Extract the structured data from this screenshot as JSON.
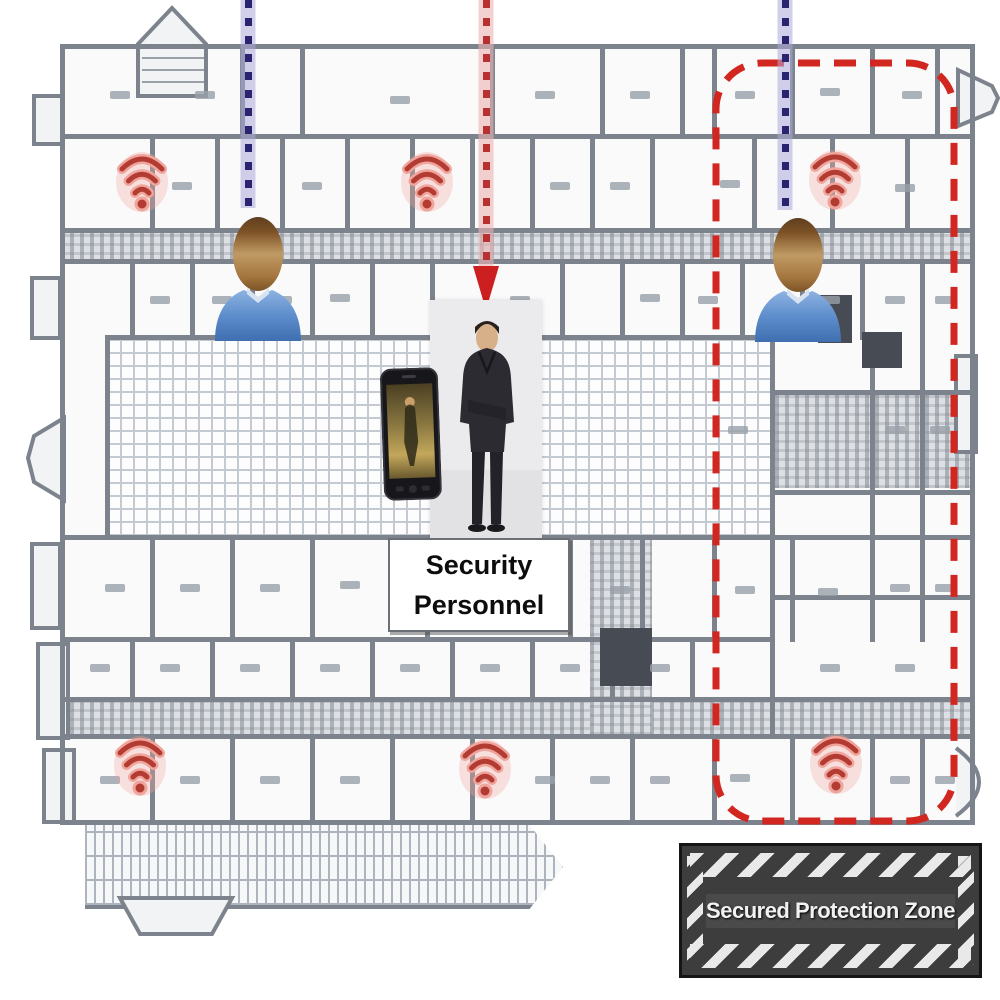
{
  "scene": {
    "description": "Building floor plan with security monitoring overlay",
    "background": "#ffffff"
  },
  "floor_plan": {
    "wall_color": "#7d838c",
    "hatch_color": "#c4cad2",
    "corridor_color": "#dcdfe3"
  },
  "secured_zone": {
    "x": 716,
    "y": 63,
    "w": 238,
    "h": 758,
    "corner_radius": 46,
    "color": "#d22720",
    "dash_pattern": "22 14",
    "stroke_width": 7
  },
  "sign": {
    "text": "Secured Protection Zone",
    "x": 679,
    "y": 843,
    "w": 303,
    "h": 135,
    "bg": "#3d3d3d",
    "stripe_color": "#e9e9e9",
    "border": "#151515",
    "text_color": "#f1f1f1"
  },
  "guard_label": {
    "line1": "Security",
    "line2": "Personnel",
    "x": 388,
    "y": 538,
    "w": 178,
    "h": 90,
    "bg": "#ffffff",
    "text_color": "#0d0d0d"
  },
  "tracking_lines": [
    {
      "id": "tracking-line-left",
      "x": 248,
      "y_start": 0,
      "y_end": 208,
      "dot_color": "#2a2370",
      "halo_color": "rgba(173,168,216,0.55)"
    },
    {
      "id": "tracking-line-right",
      "x": 785,
      "y_start": 0,
      "y_end": 210,
      "dot_color": "#2a2370",
      "halo_color": "rgba(173,168,216,0.55)"
    }
  ],
  "alert_arrow": {
    "x": 486,
    "y_start": 0,
    "shaft_end": 266,
    "tip_y": 310,
    "dot_color": "#b83030",
    "halo_color": "rgba(235,178,178,0.6)",
    "head_color": "#cc1f1f"
  },
  "wifi_access_points": [
    {
      "x": 142,
      "y": 183
    },
    {
      "x": 427,
      "y": 183
    },
    {
      "x": 835,
      "y": 181
    },
    {
      "x": 140,
      "y": 767
    },
    {
      "x": 485,
      "y": 770
    },
    {
      "x": 836,
      "y": 765
    }
  ],
  "wifi_style": {
    "arc_color": "#b23b32",
    "glow_color": "#efa49c"
  },
  "monitored_persons": [
    {
      "x": 258,
      "y": 206
    },
    {
      "x": 798,
      "y": 207
    }
  ],
  "person_style": {
    "shirt_color": "#5d8dcb",
    "skin_color": "#b98a55"
  },
  "security_guard": {
    "x": 430,
    "y": 300,
    "w": 112,
    "h": 238
  },
  "smartphone": {
    "x": 382,
    "y": 368,
    "w": 58,
    "h": 132
  }
}
